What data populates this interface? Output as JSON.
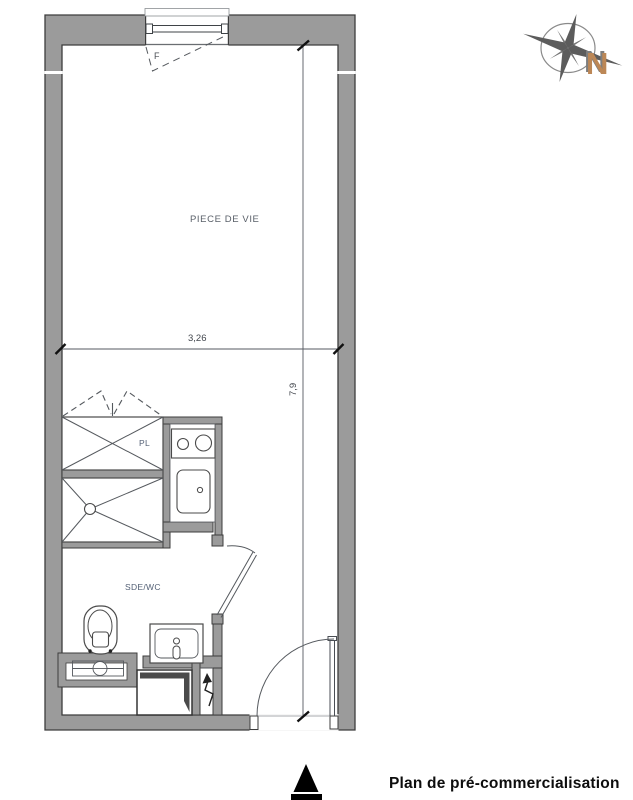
{
  "plan": {
    "room_labels": {
      "living_room": "PIECE DE VIE",
      "closet": "PL",
      "bathroom": "SDE/WC",
      "window": "F"
    },
    "dimensions": {
      "width_m": "3,26",
      "height_m": "7,9"
    },
    "compass": {
      "north": "N"
    },
    "caption": "Plan de pré-commercialisation",
    "colors": {
      "wall_fill": "#9b9b9b",
      "wall_outline": "#3d3d3d",
      "thin_line": "#5a5e63",
      "room_label_text": "#595f68",
      "bathroom_label_text": "#546176",
      "dimension_text": "#43474e",
      "north_letter": "#bc8756",
      "caption_text": "#0d0d0d"
    }
  }
}
